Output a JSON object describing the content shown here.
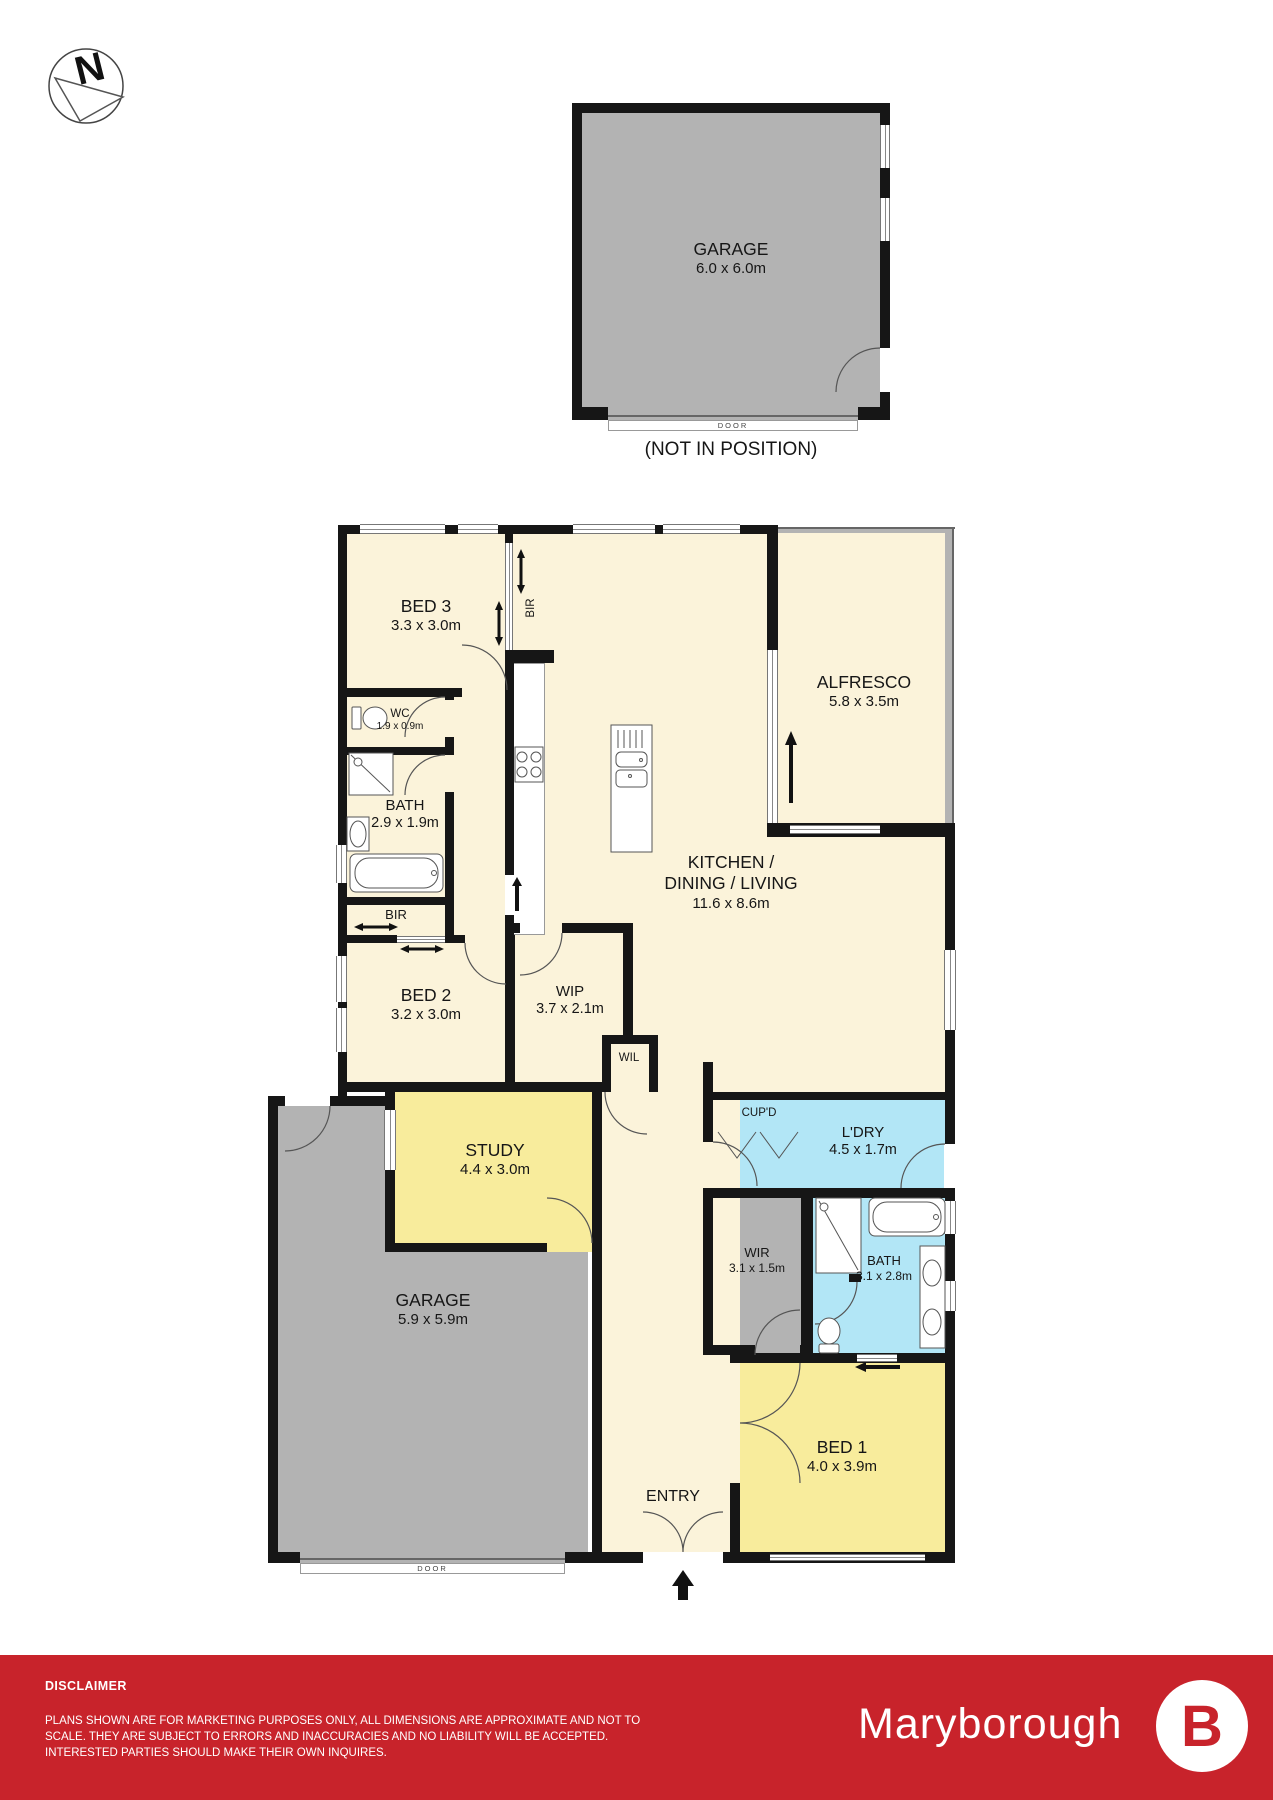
{
  "compass": {
    "letter": "N"
  },
  "detached_garage": {
    "label": "GARAGE",
    "dims": "6.0 x 6.0m",
    "door_label": "DOOR",
    "caption": "(NOT IN POSITION)"
  },
  "rooms": {
    "bed3": {
      "label": "BED 3",
      "dims": "3.3 x 3.0m"
    },
    "bir_bed3": {
      "label": "BIR"
    },
    "wc": {
      "label": "WC",
      "dims": "1.9 x 0.9m"
    },
    "bath": {
      "label": "BATH",
      "dims": "2.9 x 1.9m"
    },
    "bir_bed2": {
      "label": "BIR"
    },
    "bed2": {
      "label": "BED 2",
      "dims": "3.2 x 3.0m"
    },
    "kitchen_dining_living": {
      "label": "KITCHEN /",
      "label2": "DINING / LIVING",
      "dims": "11.6 x 8.6m"
    },
    "alfresco": {
      "label": "ALFRESCO",
      "dims": "5.8 x 3.5m"
    },
    "wip": {
      "label": "WIP",
      "dims": "3.7 x 2.1m"
    },
    "wil": {
      "label": "WIL"
    },
    "study": {
      "label": "STUDY",
      "dims": "4.4 x 3.0m"
    },
    "garage": {
      "label": "GARAGE",
      "dims": "5.9 x 5.9m",
      "door_label": "DOOR"
    },
    "cupd": {
      "label": "CUP'D"
    },
    "ldry": {
      "label": "L'DRY",
      "dims": "4.5 x 1.7m"
    },
    "wir": {
      "label": "WIR",
      "dims": "3.1 x 1.5m"
    },
    "bath_ens": {
      "label": "BATH",
      "dims": "3.1 x 2.8m"
    },
    "bed1": {
      "label": "BED 1",
      "dims": "4.0 x 3.9m"
    },
    "entry": {
      "label": "ENTRY"
    }
  },
  "footer": {
    "heading": "DISCLAIMER",
    "body": "PLANS SHOWN ARE FOR MARKETING PURPOSES ONLY, ALL DIMENSIONS ARE APPROXIMATE AND NOT TO SCALE. THEY ARE SUBJECT TO ERRORS AND INACCURACIES AND NO LIABILITY WILL BE ACCEPTED. INTERESTED PARTIES SHOULD MAKE THEIR OWN INQUIRES.",
    "brand": "Maryborough",
    "logo_letter": "B"
  },
  "colors": {
    "bedroom": "#f8ec9c",
    "living": "#fbf3da",
    "wet": "#b2e6f6",
    "zone": "#b3b3b3",
    "wall": "#161616",
    "footer": "#c8232b",
    "line": "#555555"
  }
}
